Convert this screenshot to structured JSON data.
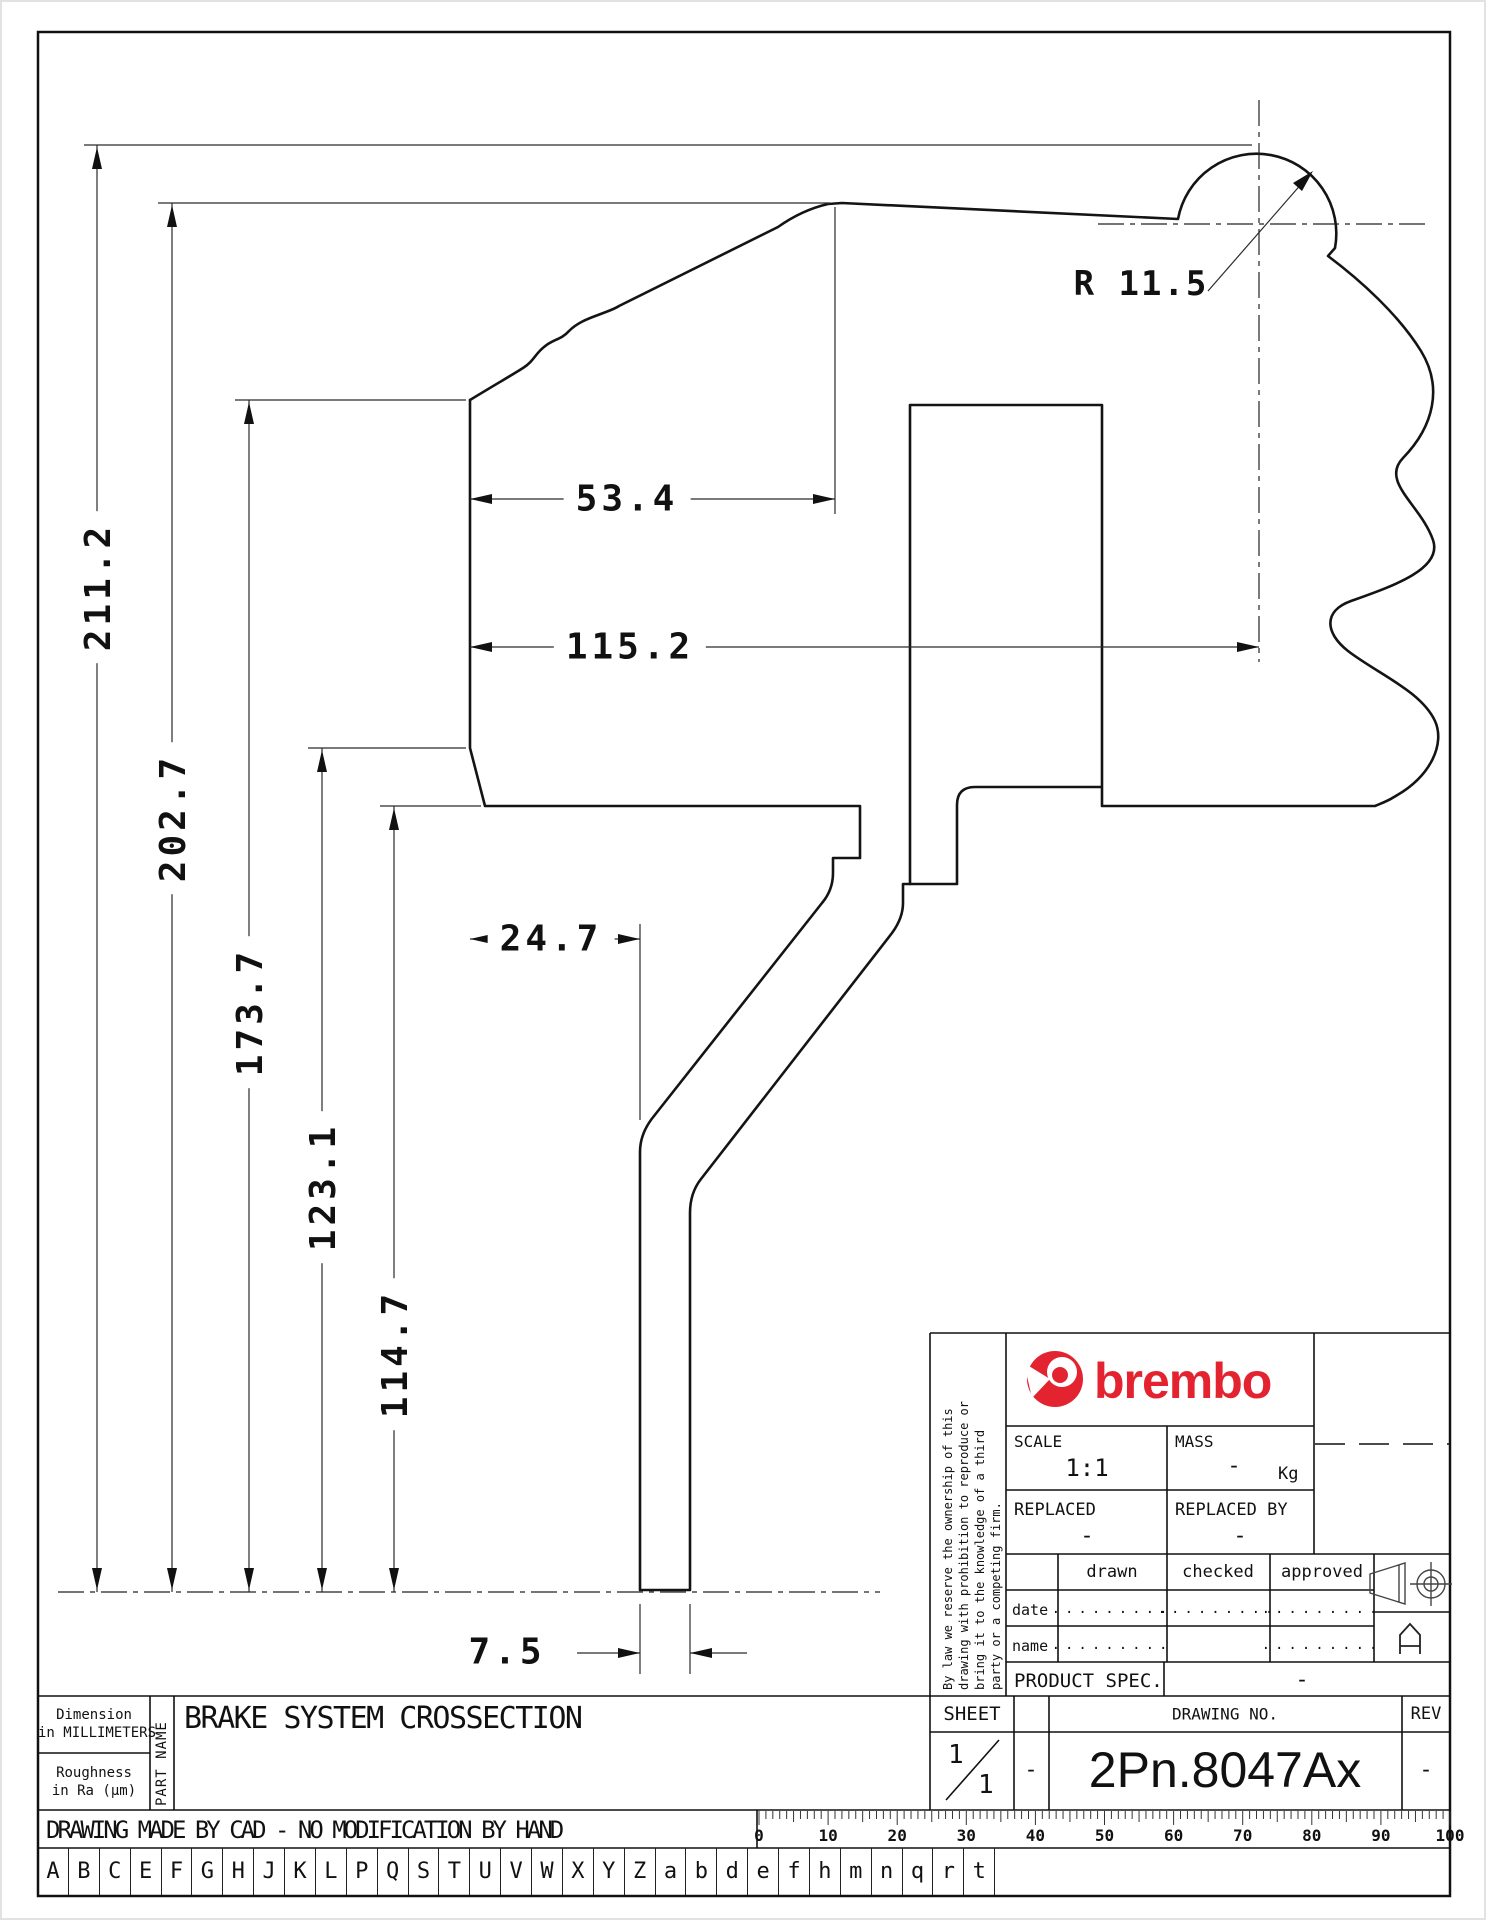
{
  "dims": {
    "v": [
      "211.2",
      "202.7",
      "173.7",
      "123.1",
      "114.7"
    ],
    "h": [
      "53.4",
      "115.2",
      "24.7",
      "7.5"
    ],
    "radius": "R 11.5"
  },
  "title_block": {
    "disclaimer_lines": [
      "By law we reserve the ownership of this",
      "drawing with prohibition to reproduce or",
      "bring it to the knowledge of a third",
      "party or a competing firm."
    ],
    "brand": "brembo",
    "scale_label": "SCALE",
    "scale_value": "1:1",
    "mass_label": "MASS",
    "mass_value": "-",
    "mass_unit": "Kg",
    "replaced_label": "REPLACED",
    "replaced_value": "-",
    "replaced_by_label": "REPLACED BY",
    "replaced_by_value": "-",
    "drawn_label": "drawn",
    "checked_label": "checked",
    "approved_label": "approved",
    "date_label": "date",
    "name_label": "name",
    "dots": ".........",
    "product_spec_label": "PRODUCT SPEC.",
    "product_spec_value": "-",
    "sheet_label": "SHEET",
    "sheet_num": "1",
    "sheet_total": "1",
    "sheet_sep_value": "-",
    "drawing_no_label": "DRAWING NO.",
    "drawing_no": "2Pn.8047Ax",
    "rev_label": "REV",
    "rev_value": "-"
  },
  "footer": {
    "dimension_note_line1": "Dimension",
    "dimension_note_line2": "in MILLIMETERS",
    "roughness_note_line1": "Roughness",
    "roughness_note_line2": "in Ra (μm)",
    "part_name_label": "PART NAME",
    "part_name": "BRAKE SYSTEM CROSSECTION",
    "cad_note": "DRAWING MADE BY CAD - NO MODIFICATION BY HAND",
    "letters": [
      "A",
      "B",
      "C",
      "E",
      "F",
      "G",
      "H",
      "J",
      "K",
      "L",
      "P",
      "Q",
      "S",
      "T",
      "U",
      "V",
      "W",
      "X",
      "Y",
      "Z",
      "a",
      "b",
      "d",
      "e",
      "f",
      "h",
      "m",
      "n",
      "q",
      "r",
      "t"
    ],
    "ruler_labels": [
      "0",
      "10",
      "20",
      "30",
      "40",
      "50",
      "60",
      "70",
      "80",
      "90",
      "100"
    ]
  }
}
